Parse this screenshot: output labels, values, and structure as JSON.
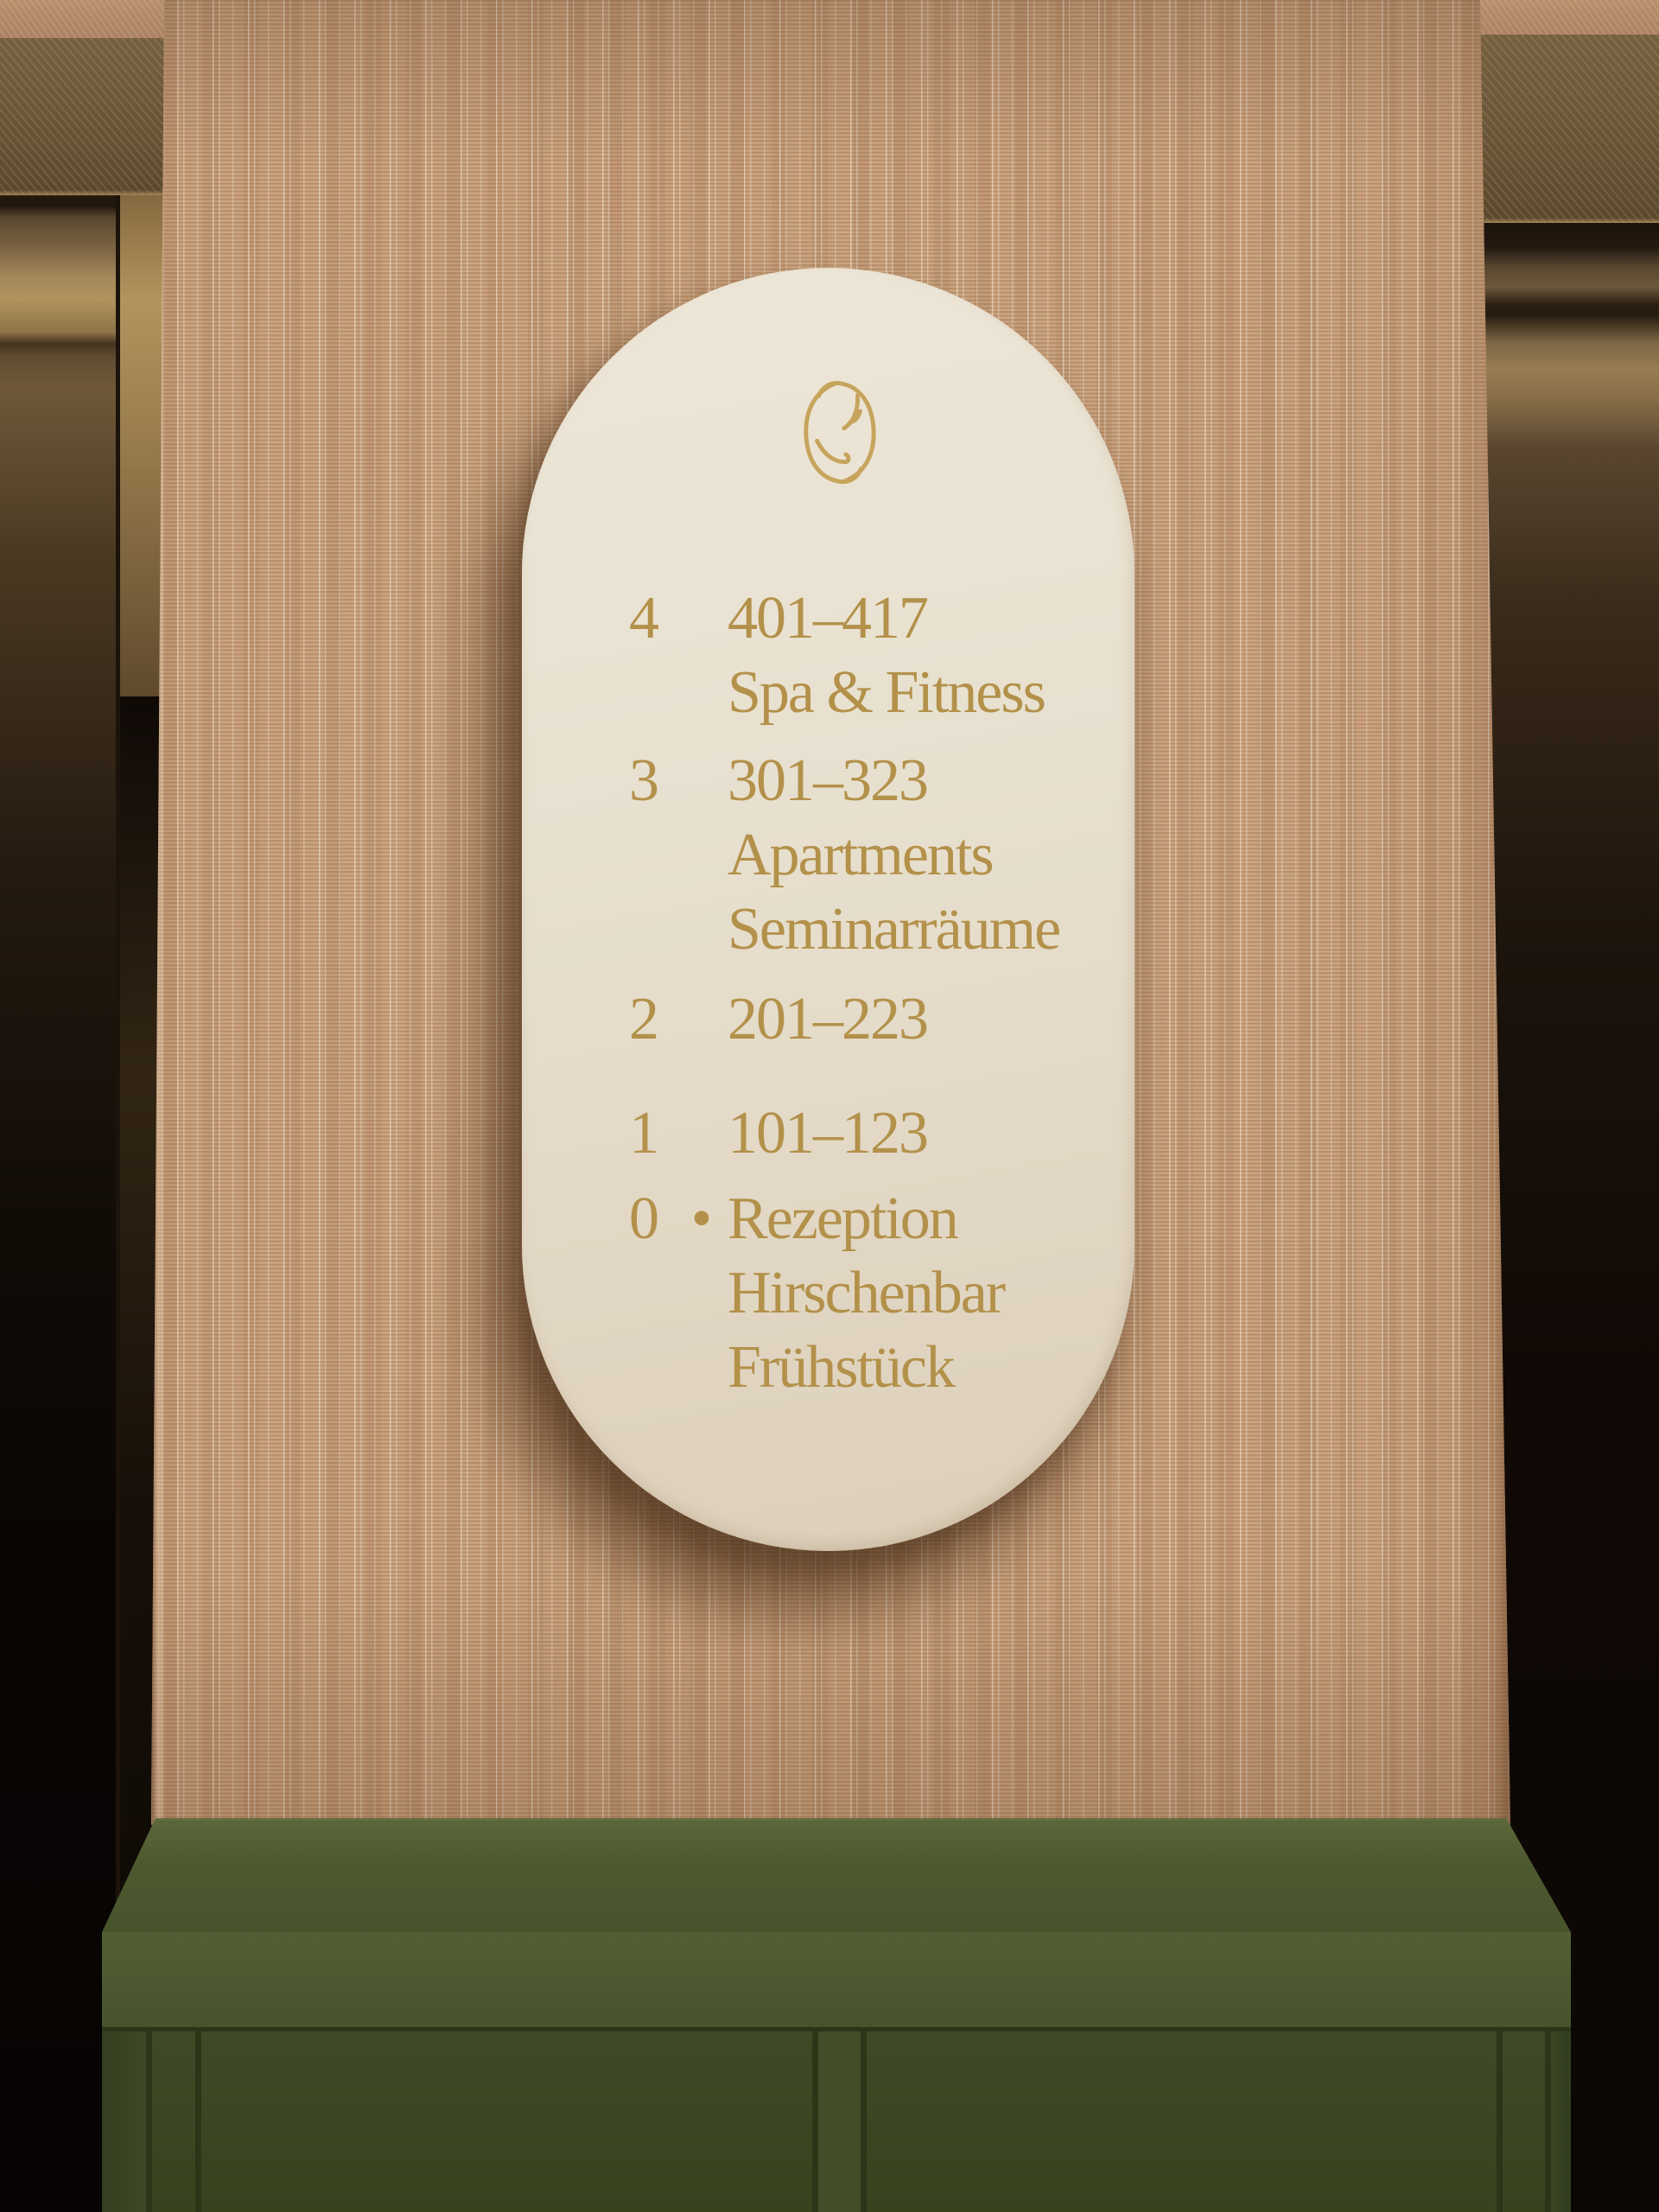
{
  "sign": {
    "logo": {
      "icon": "antler-oval-monogram-icon"
    },
    "bullet_glyph": "•",
    "floors": [
      {
        "number": "4",
        "bullet": false,
        "labels": [
          "401–417",
          "Spa & Fitness"
        ]
      },
      {
        "number": "3",
        "bullet": false,
        "labels": [
          "301–323",
          "Apartments",
          "Seminarräume"
        ]
      },
      {
        "number": "2",
        "bullet": false,
        "labels": [
          "201–223"
        ]
      },
      {
        "number": "1",
        "bullet": false,
        "labels": [
          "101–123"
        ]
      },
      {
        "number": "0",
        "bullet": true,
        "labels": [
          "Rezeption",
          "Hirschenbar",
          "Frühstück"
        ]
      }
    ],
    "colors": {
      "plate_cream": "#E8E0CF",
      "text_gold": "#B3914A"
    }
  },
  "environment": {
    "colors": {
      "wallpaper_tan": "#C89F79",
      "cabinet_green": "#42502A",
      "elevator_bronze": "#8A7050",
      "background_dark": "#0C0705"
    }
  }
}
